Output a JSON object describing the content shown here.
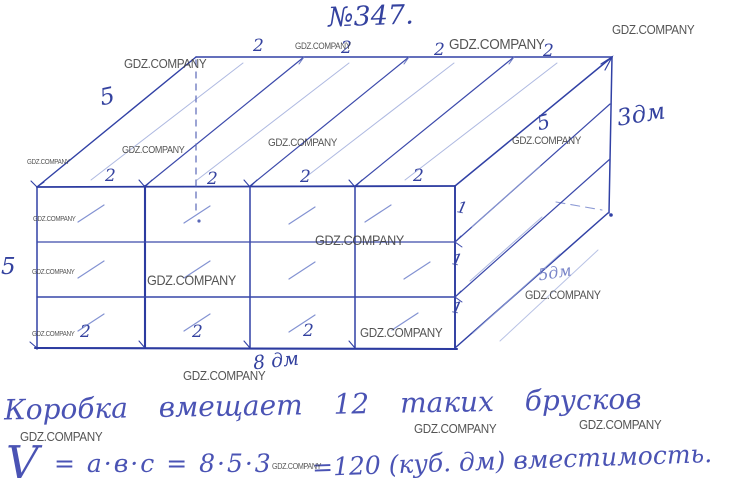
{
  "watermark": {
    "text": "GDZ.COMPANY"
  },
  "title": {
    "problem_number": "№347."
  },
  "diagram": {
    "top_back_edge_labels": [
      "2",
      "2",
      "2",
      "2"
    ],
    "top_front_edge_labels": [
      "2",
      "2",
      "2",
      "2"
    ],
    "bottom_edge_labels": [
      "2",
      "2",
      "2"
    ],
    "right_face_row_labels": [
      "1",
      "1",
      "1"
    ],
    "depth_label_left": "5",
    "depth_label_right": "5",
    "front_left_label": "5",
    "height_dim_label": "3дм",
    "depth_dim_label": "5дм",
    "length_dim_label": "8 дм"
  },
  "solution": {
    "line1": "Коробка вмещает 12 таких брусков",
    "volume_symbol": "V",
    "formula_left": "= a·в·c = 8·5·3",
    "formula_right": "=120 (куб. дм) вместимость."
  }
}
